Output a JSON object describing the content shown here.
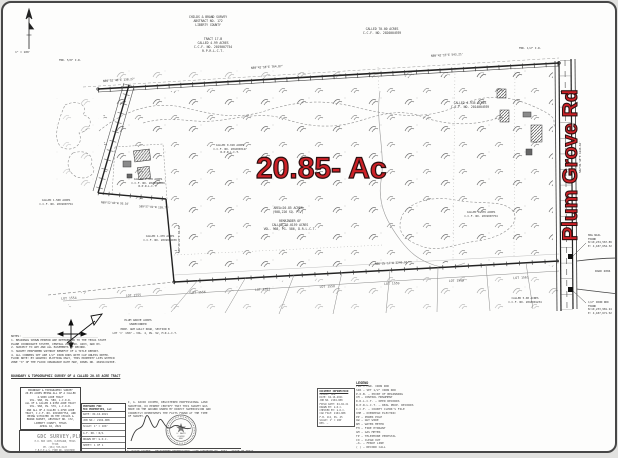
{
  "colors": {
    "accent_red": "#cd2127",
    "ink": "#3c3c3c",
    "paper": "#fdfdfc"
  },
  "annotations": {
    "area_label": "20.85- Ac",
    "road_label": "Plum Grove Rd"
  },
  "compass": {
    "scale_note": "1\" = 100'"
  },
  "survey": {
    "survey_header": "CHILDS & BRAND SURVEY\nABSTRACT NO. 172\nLIBERTY COUNTY",
    "tract_block": "TRACT 17-B\nCALLED 4.99 ACRES\nC.C.F. NO. 2019007754\nR.P.R.L.C.T.",
    "called70_top": "CALLED 70.00 ACRES\nC.C.F. NO. 2020004939",
    "bearings": {
      "top1": "N89°52'48\"E   138.27'",
      "top2": "N89°42'18\"E   764.87'",
      "top3": "N89°42'15\"E   543.21'",
      "right": "S02°01'18\"E   1246.64'",
      "bottom": "N86°25'17\"W   2246.91'",
      "bl1": "N89°52'03\"W  93.10'",
      "bl2": "S89°57'01\"W  138.74'",
      "step": "S00°40'24\"E  84.04'"
    },
    "parcels": {
      "p4935": "CALLED 4.935 ACRES\nC.C.F. NO. 2014004939",
      "p_unrec": "CALLED 0.918 ACRES\nC.C.F. NO. 2016003127\nR.P.R.L.C.T.",
      "p_area": "AREA=20.85 ACRES\n(908,226 SQ. FT.)",
      "p_rem": "REMAINDER OF\nCALLED 70.0159 ACRES\nVOL. 968, PG. 586, D.R.L.C.T.",
      "p1478": "CALLED 1.478 ACRES\nC.C.F. NO. 2020004939\nR.P.R.L.C.T.",
      "p1500": "CALLED 1.500 ACRES\nC.C.F. NO. 2019007754",
      "p1479": "CALLED 1.479 ACRES\nC.C.F. NO. 2019004939",
      "p_pond": "CALLED 0.479 ACRES\nC.C.F. NO. 2019007754",
      "p5br": "CALLED 5.00 ACRES\nC.C.F. NO. 2018001234",
      "grove": "PLUM GROVE ACRES\nUNRECORDED",
      "gully": "PROP. GUM GULLY ROAD, SECTION B\nLOT 'C' 1307 — VOL. 4, PG. 92, M.R.L.C.T."
    },
    "monuments": {
      "fnd_tl": "FND. 5/8\" I.R.",
      "fnd_tr": "FND. 1/2\" I.R.",
      "mag_nail": "MAG NAIL\nFOUND\nN:10,234,567.89\nE: 4,187,654.32",
      "iron_rod": "1/2\" IRON ROD\nFOUND\nN:10,233,981.24\nE: 4,187,671.52",
      "side_road": "ROAD 2004",
      "bm_note": "SCALED FLAG NOTED\n(SEE PAGE 2)"
    }
  },
  "lots": {
    "items": [
      "LOT 1554",
      "LOT 1555",
      "LOT 1556",
      "LOT 1557",
      "LOT 1558",
      "LOT 1559",
      "LOT 1560",
      "LOT 1561"
    ]
  },
  "notes": {
    "notes_body": "NOTES: ______________________________________________\n1. BEARINGS SHOWN HEREON ARE REFERENCED TO THE TEXAS STATE\n    PLANE COORDINATE SYSTEM, CENTRAL ZONE NO. 4203, NAD 83.\n2. SUBJECT TO ANY AND ALL EASEMENTS OF RECORD.\n3. SURVEY PERFORMED WITHOUT BENEFIT OF A TITLE REPORT.\n4. ALL CORNERS SET ARE 1/2\" IRON RODS WITH CAP UNLESS NOTED.",
    "flood_body": "FLOOD NOTE: BY GRAPHIC PLOTTING ONLY, THIS PROPERTY LIES WITHIN\nZONE \"X\" OF THE FLOOD INSURANCE RATE MAP, PANEL NO. 48291C0230E.",
    "heading": "BOUNDARY & TOPOGRAPHIC SURVEY OF A CALLED 20.85 ACRE TRACT"
  },
  "titleblock": {
    "description": "BOUNDARY & TOPOGRAPHIC SURVEY\n20.85 ACRES BEING ALL OF A CALLED\n4.9900 ACRE TRACT\nVOL. 968, PG. 586, L.C.D.R.\nALL OF A CALLED 4.9350 ACRE TRACT\nVOL. 968, PG. 576, L.C.D.R.\nAND ALL OF A CALLED 1.4790 ACRE\nTRACT, C.C.F. NO. 2019007754, AND\nBEING SITUATED IN THE CHILDS &\nBRAND SURVEY, ABSTRACT NO. 172,\nLIBERTY COUNTY, TEXAS\nAPRIL 16, 2021",
    "firm_name": "GDC SURVEY,PLLC",
    "firm_sub": "P.O. BOX 1205, CLEVELAND, TEXAS 77328\nPH. (281) 555-0123\nT.B.P.E.L.S. FIRM NO. 10193900",
    "fields_header": "PREPARED FOR:\nMCD PROPERTIES, LLC",
    "fields_rows": [
      "DATE: 04-16-2021",
      "JOB NO.: 2104-088",
      "SCALE: 1\" = 100'",
      "G.F. NO.: N/A",
      "DRAWN BY: G.D.C.",
      "SHEET: 1 OF 1"
    ],
    "certificate": "I, G. DAVID COOPER, REGISTERED PROFESSIONAL LAND\nSURVEYOR, DO HEREBY CERTIFY THAT THIS SURVEY WAS\nMADE ON THE GROUND UNDER MY DIRECT SUPERVISION AND\nCORRECTLY REPRESENTS THE FACTS FOUND AT THE TIME\nOF SURVEY.",
    "surveyor_line": "G. DAVID COOPER — REGISTERED PROFESSIONAL LAND SURVEYOR NO. 4967 — STATE OF TEXAS",
    "seal_center": "G. DAVID\nCOOPER\n4967"
  },
  "legend": {
    "title": "LEGEND",
    "rows": [
      "FIR — FND. IRON ROD",
      "SIR — SET 1/2\" IRON ROD",
      "P.O.B. — POINT OF BEGINNING",
      "CM — CONTROL MONUMENT",
      "D.R.L.C.T. — DEED RECORDS",
      "R.P.R.L.C.T. — REAL PROP. RECORDS",
      "C.C.F. — COUNTY CLERK'S FILE",
      "OHE — OVERHEAD ELECTRIC",
      "PP — POWER POLE",
      "GW — GUY WIRE",
      "WM — WATER METER",
      "FH — FIRE HYDRANT",
      "GM — GAS METER",
      "TP — TELEPHONE PEDESTAL",
      "CO — CLEAN OUT",
      "—X— — FENCE LINE",
      "( ) — RECORD CALL"
    ]
  },
  "docinfo": {
    "title": "DOCUMENT INFORMATION",
    "body": "CLIENT: MCD\nDATE: 04-16-2021\nJOB NO. 2104-088\nFIELD DATE: 04-02-21\nDRAWN BY: G.D.C.\nCHECKED BY: G.D.C.\nCAD FILE: 2104-088\nF.B. 112, PG. 45\nSCALE: 1\" = 100'\nREV. —"
  }
}
